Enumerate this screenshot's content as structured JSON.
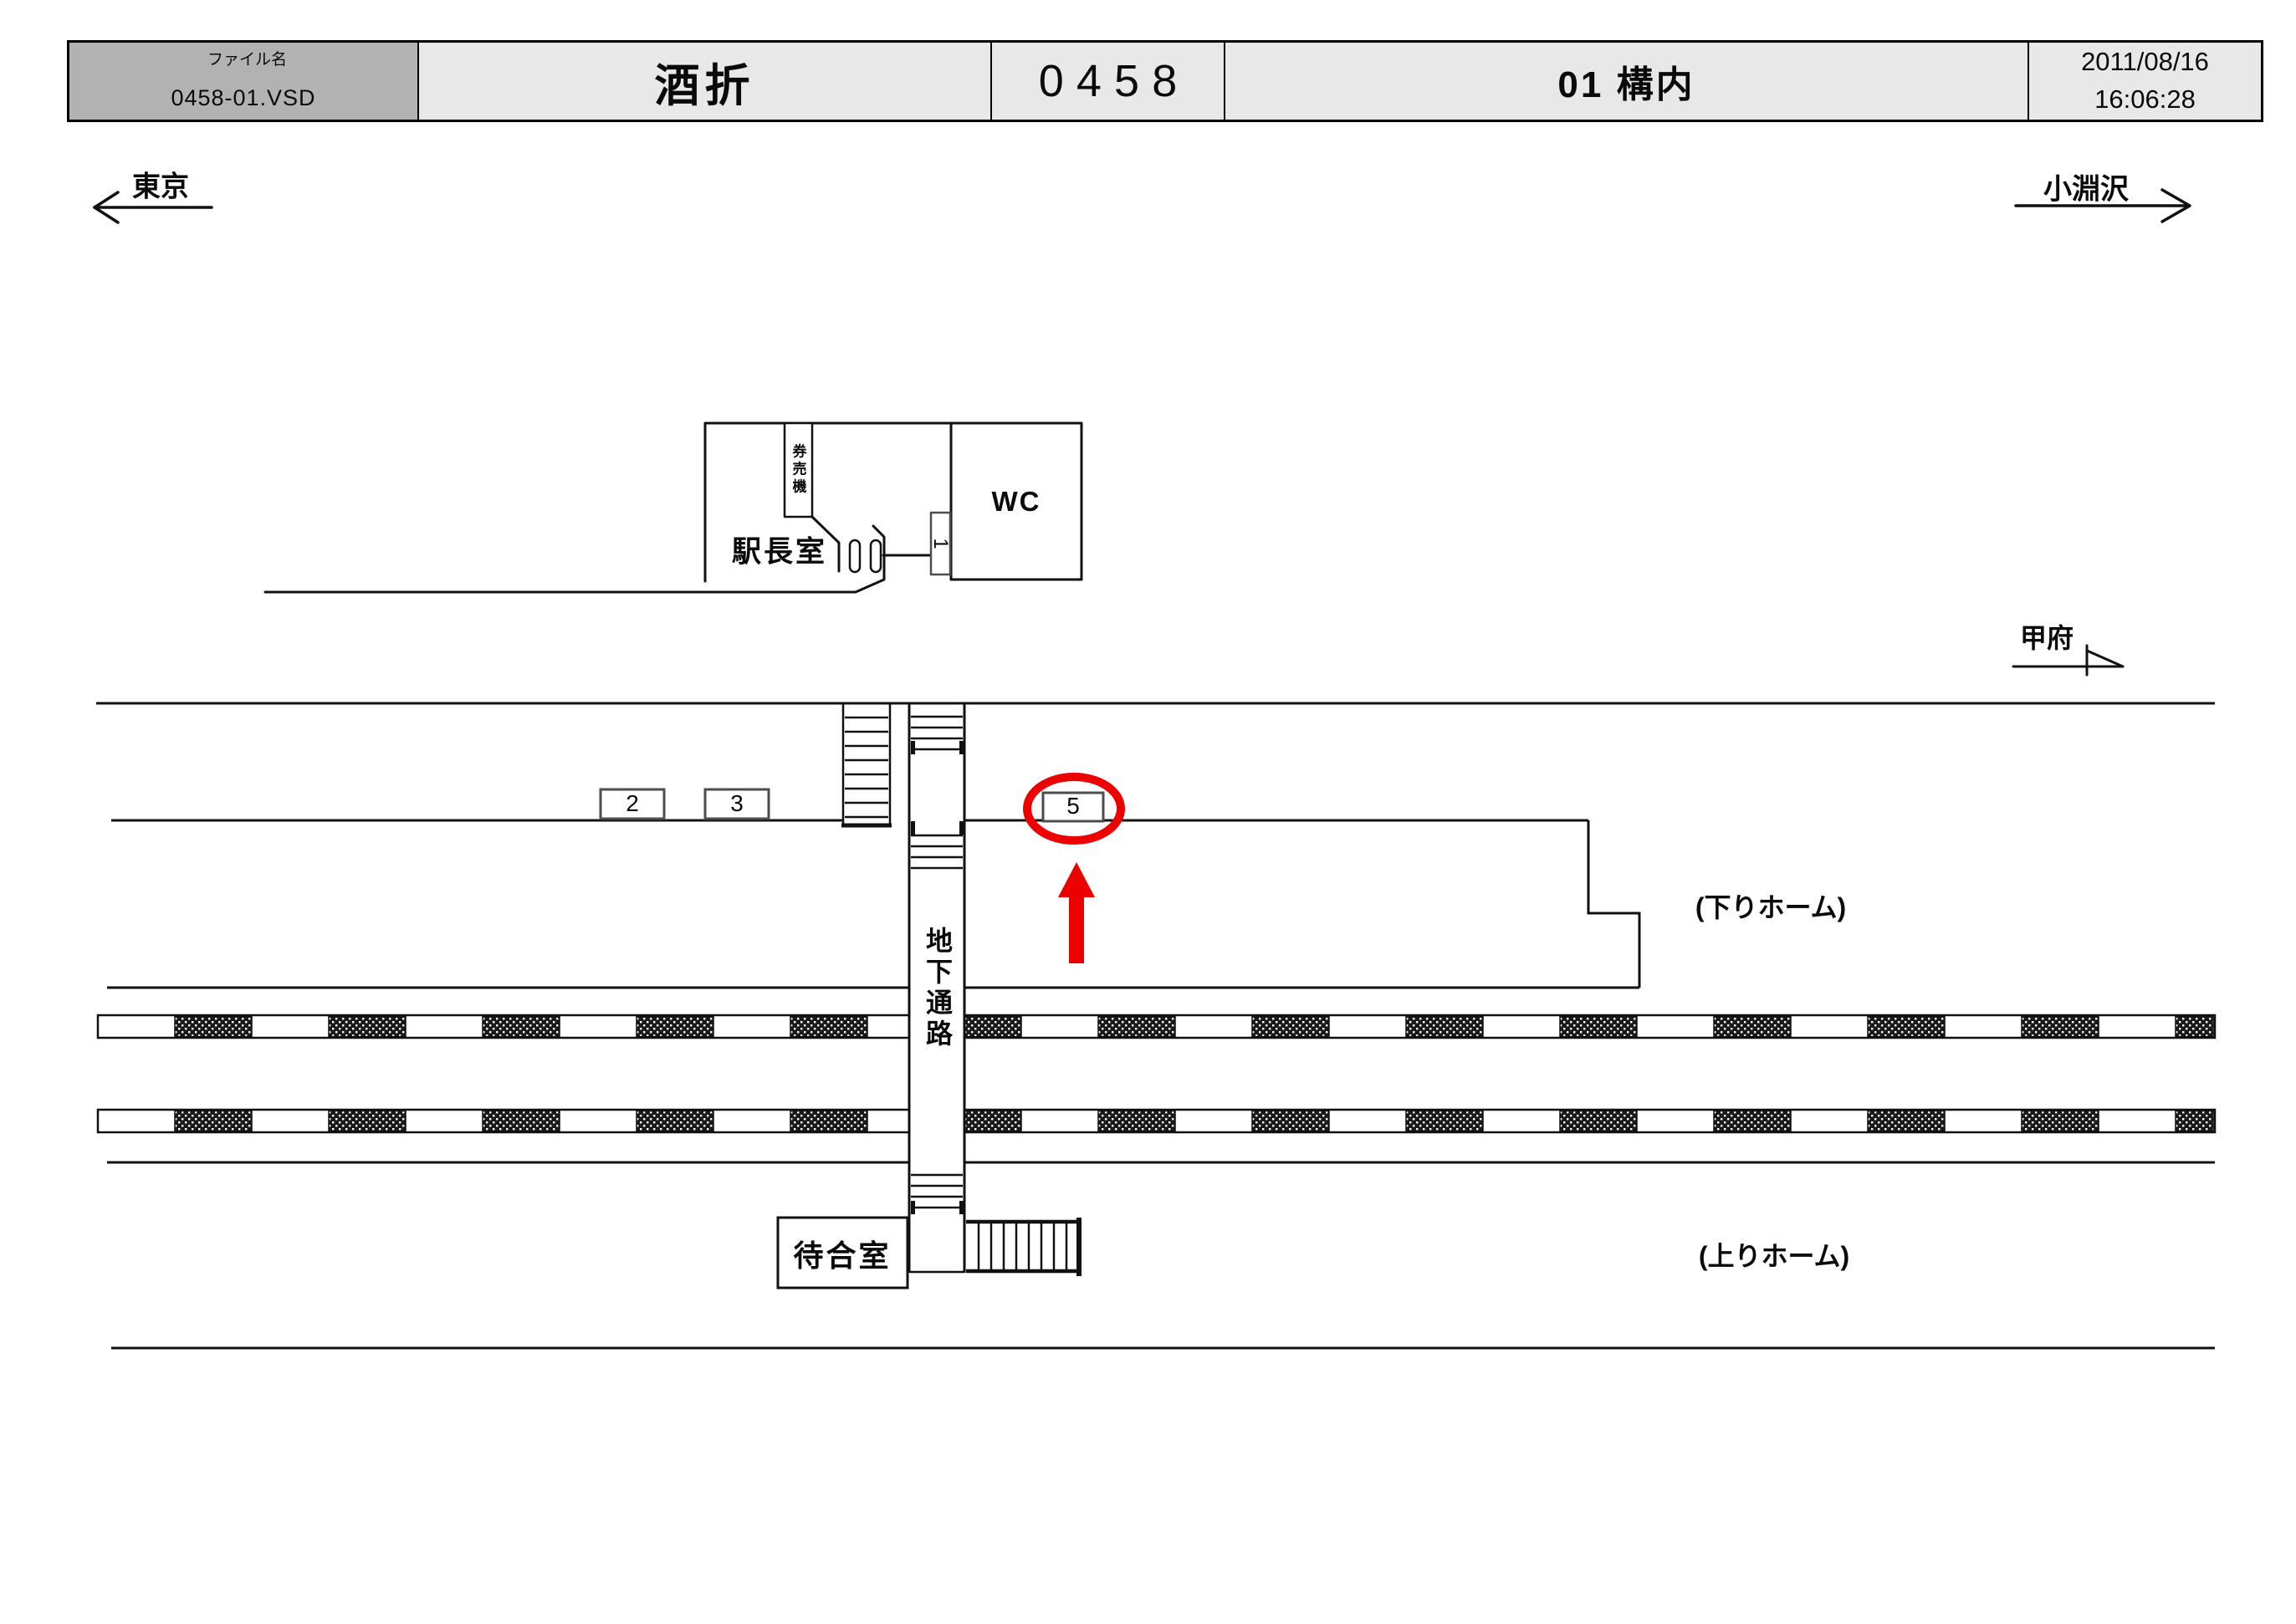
{
  "header": {
    "file_label": "ファイル名",
    "file_value": "0458-01.VSD",
    "station_name": "酒折",
    "station_code": "0458",
    "sheet_title": "01 構内",
    "date": "2011/08/16",
    "time": "16:06:28"
  },
  "directions": {
    "left_terminal": "東京",
    "right_terminal": "小淵沢",
    "kofu": "甲府"
  },
  "labels": {
    "station_master_room": "駅長室",
    "ticket_machine": "券売機",
    "toilet": "WC",
    "underground_passage": "地下通路",
    "waiting_room": "待合室",
    "down_platform": "(下りホーム)",
    "up_platform": "(上りホーム)"
  },
  "signs": {
    "no1": "1",
    "no2": "2",
    "no3": "3",
    "no5": "5"
  },
  "colors": {
    "highlight_red": "#ed0000",
    "header_cell_grey": "#b2b2b2",
    "header_cell_light": "#e8e8e8",
    "line_black": "#111111",
    "sign_border_grey": "#4d4d4d"
  }
}
